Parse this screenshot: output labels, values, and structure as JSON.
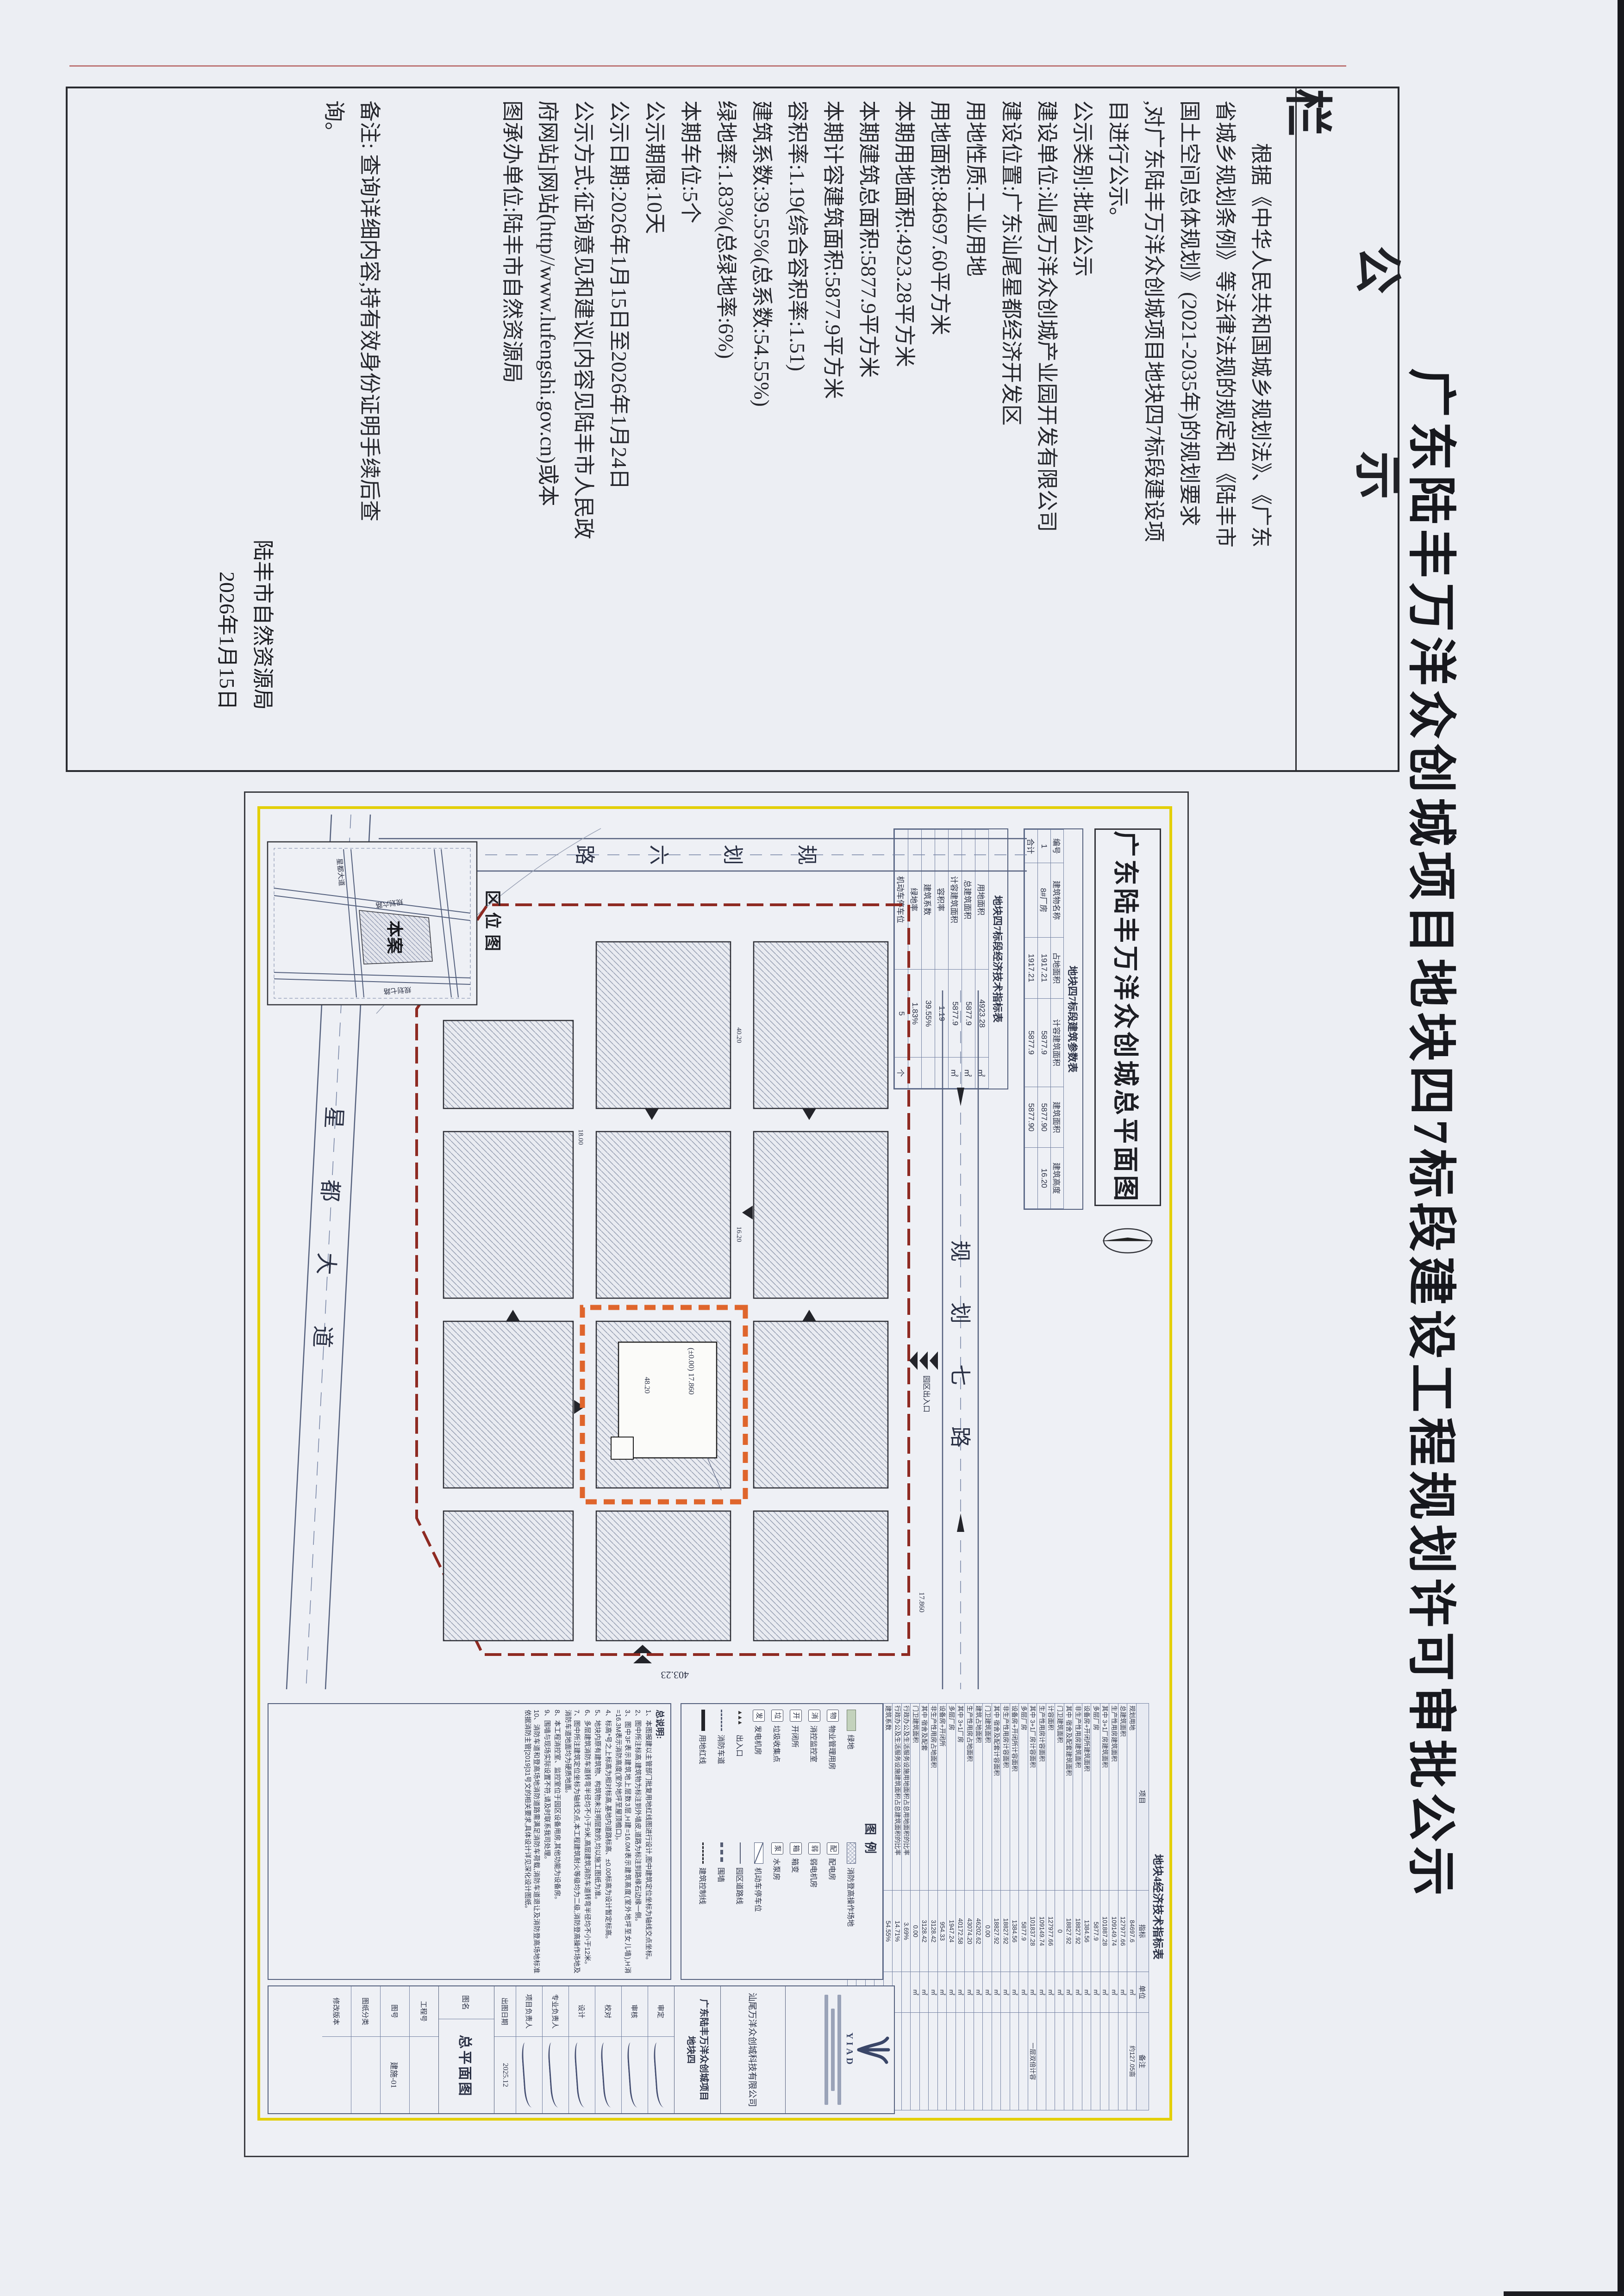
{
  "page": {
    "title": "广东陆丰万洋众创城项目地块四7标段建设工程规划许可审批公示"
  },
  "notice": {
    "header": "公示栏",
    "lines": [
      "根据《中华人民共和国城乡规划法》、《广东",
      "省城乡规划条例》等法律法规的规定和《陆丰市",
      "国土空间总体规划》(2021-2035年)的规划要求",
      ",对广东陆丰万洋众创城项目地块四7标段建设项",
      "目进行公示。",
      "公示类别:批前公示",
      "建设单位:汕尾万洋众创城产业园开发有限公司",
      "建设位置:广东汕尾星都经济开发区",
      "用地性质:工业用地",
      "用地面积:84697.60平方米",
      "本期用地面积:4923.28平方米",
      "本期建筑总面积:5877.9平方米",
      "本期计容建筑面积:5877.9平方米",
      "容积率:1.19(综合容积率:1.51)",
      "建筑系数:39.55%(总系数:54.55%)",
      "绿地率:1.83%(总绿地率:6%)",
      "本期车位:5个",
      "公示期限:10天",
      "公示日期:2026年1月15日至2026年1月24日",
      "公示方式:征询意见和建议[内容见陆丰市人民政",
      "府网站]网站(http//www.lufengshi.gov.cn)或本",
      "图承办单位:陆丰市自然资源局",
      "",
      "",
      "",
      "备注: 查询详细内容,持有效身份证明手续后查",
      "询。",
      ""
    ],
    "sign_org": "陆丰市自然资源局",
    "sign_date": "2026年1月15日"
  },
  "plan": {
    "title": "广东陆丰万洋众创城总平面图",
    "param_table": {
      "title": "地块四7标段建筑参数表",
      "headers": [
        "编号",
        "建筑物名称",
        "占地面积",
        "计容建筑面积",
        "建筑面积",
        "建筑高度"
      ],
      "rows": [
        [
          "1",
          "8#厂房",
          "1917.21",
          "5877.9",
          "5877.90",
          "16.20"
        ],
        [
          "合计",
          "",
          "1917.21",
          "5877.9",
          "5877.90",
          ""
        ]
      ]
    },
    "section_table": {
      "title": "地块四7标段经济技术指标表",
      "rows": [
        [
          "用地面积",
          "4923.28",
          "㎡"
        ],
        [
          "总建筑面积",
          "5877.9",
          "㎡"
        ],
        [
          "计容建筑面积",
          "5877.9",
          "㎡"
        ],
        [
          "容积率",
          "1.19",
          ""
        ],
        [
          "建筑系数",
          "39.55%",
          ""
        ],
        [
          "绿地率",
          "1.83%",
          ""
        ],
        [
          "机动车停车位",
          "5",
          "个"
        ]
      ]
    },
    "main_table": {
      "title": "地块4经济技术指标表",
      "headers": [
        "项目",
        "指标",
        "单位",
        "备注"
      ],
      "rows": [
        [
          "规划用地",
          "84697.6",
          "㎡",
          "约127.05亩"
        ],
        [
          "总建筑面积",
          "127977.66",
          "㎡",
          ""
        ],
        [
          "生产性用房建筑面积",
          "109149.74",
          "㎡",
          ""
        ],
        [
          "其中 3+1厂房建筑面积",
          "101887.28",
          "㎡",
          ""
        ],
        [
          "多层厂房",
          "5877.9",
          "㎡",
          ""
        ],
        [
          "设备房+开闭所建筑面积",
          "1384.56",
          "㎡",
          ""
        ],
        [
          "非生产性用房建筑面积",
          "18827.92",
          "㎡",
          ""
        ],
        [
          "其中 宿舍及配套建筑面积",
          "18827.92",
          "㎡",
          ""
        ],
        [
          "门卫建筑面积",
          "0",
          "㎡",
          ""
        ],
        [
          "计容面积",
          "127977.66",
          "㎡",
          ""
        ],
        [
          "生产性用房计容面积",
          "109149.74",
          "㎡",
          ""
        ],
        [
          "其中 3+1厂房计容面积",
          "101837.28",
          "㎡",
          "一层双倍计容"
        ],
        [
          "多层厂房",
          "5877.9",
          "㎡",
          ""
        ],
        [
          "设备房+开闭所计容面积",
          "1384.56",
          "㎡",
          ""
        ],
        [
          "非生产性用房计容面积",
          "18827.92",
          "㎡",
          ""
        ],
        [
          "其中 宿舍及配套计容面积",
          "18827.92",
          "㎡",
          ""
        ],
        [
          "门卫建筑面积",
          "0.00",
          "㎡",
          ""
        ],
        [
          "建筑占地面积",
          "46202.62",
          "㎡",
          ""
        ],
        [
          "生产性用房占地面积",
          "43074.20",
          "㎡",
          ""
        ],
        [
          "其中 3+1厂房",
          "40172.58",
          "㎡",
          ""
        ],
        [
          "多层厂房",
          "1947.24",
          "㎡",
          ""
        ],
        [
          "设备房+开闭所",
          "954.33",
          "㎡",
          ""
        ],
        [
          "非生产性用房占地面积",
          "3128.42",
          "㎡",
          ""
        ],
        [
          "其中 宿舍及配套",
          "3128.42",
          "㎡",
          ""
        ],
        [
          "门卫建筑面积",
          "0.00",
          "㎡",
          ""
        ],
        [
          "行政办公及生活服务设施用地面积占总用地面积的比率",
          "3.69%",
          "",
          ""
        ],
        [
          "行政办公及生活服务设施建筑面积占总建筑面积的比率",
          "14.71%",
          "",
          ""
        ],
        [
          "建筑系数",
          "54.55%",
          "",
          ""
        ],
        [
          "容积率",
          "1.51",
          "",
          ""
        ],
        [
          "绿地面积",
          "5066.62",
          "㎡",
          ""
        ],
        [
          "绿地率",
          "6%",
          "",
          "≤20%"
        ],
        [
          "机动车停车位",
          "256",
          "个",
          "机动车:0.2辆/100㎡"
        ]
      ]
    },
    "legend": {
      "title": "图例",
      "items": [
        {
          "label": "绿地",
          "sym": "green"
        },
        {
          "label": "消防登高操作场地",
          "sym": "hatchx"
        },
        {
          "label": "物业管理用房",
          "sym": "chip",
          "ch": "物"
        },
        {
          "label": "配电房",
          "sym": "chip",
          "ch": "配"
        },
        {
          "label": "消控监控室",
          "sym": "chip",
          "ch": "消"
        },
        {
          "label": "弱电机房",
          "sym": "chip",
          "ch": "弱"
        },
        {
          "label": "开闭所",
          "sym": "chip",
          "ch": "开"
        },
        {
          "label": "箱变",
          "sym": "chip",
          "ch": "箱"
        },
        {
          "label": "垃圾收集点",
          "sym": "chip",
          "ch": "垃"
        },
        {
          "label": "水泵房",
          "sym": "chip",
          "ch": "泵"
        },
        {
          "label": "发电机房",
          "sym": "chip",
          "ch": "发"
        },
        {
          "label": "机动车停车位",
          "sym": "boxdiag"
        },
        {
          "label": "出入口",
          "sym": "chev"
        },
        {
          "label": "园区道路线",
          "sym": "thin"
        },
        {
          "label": "消防车道",
          "sym": "dash"
        },
        {
          "label": "围墙",
          "sym": "fence"
        },
        {
          "label": "用地红线",
          "sym": "thick"
        },
        {
          "label": "建筑控制线",
          "sym": "dashdot"
        }
      ]
    },
    "notes": {
      "title": "总说明:",
      "items": [
        "1、本图报建以主管部门批复用地红线图进行设计,图中建筑定位坐标为轴线交点坐标。",
        "2、图中所注标高:建筑物为标注到外墙皮,道路为标注到路缘石边缘一侧。",
        "3、图中3F表示建筑地上层数3层,H建=16.0M表示建筑高度(室外地坪至女儿墙),H消=16.3M表示消防高度(室外地坪至屋顶檐口)。",
        "4、标高*号之上标高为相对标高,基地内道路标高、±0.00标高为设计暂定标高。",
        "5、地块内原有建筑物、构筑物未注明层数的,均以施工图纸为准。",
        "6、多层建筑消防车道转弯半径均不小于9米,高层建筑消防车道转弯半径均不小于12米。",
        "7、图中所注建筑定位坐标为轴线交点,本工程建筑耐火等级均为二级,消防登高操作场地及消防车道地面均为硬质地面。",
        "8、本工程消控室、监控室位于园区设备用房,其他功能为设备房。",
        "9、围墙与现场实际设置不符,请及时联系我司处理。",
        "10、消防车道和登高场地消防道路需满足消防车荷载,消防车道退让及消防登高场地标准依据消防主管[2019]31号文的相关要求,具体设计详见深化设计图纸。"
      ]
    },
    "roads": {
      "north": "规划七路",
      "west_chars": [
        "规",
        "划",
        "六",
        "路"
      ],
      "south": "星都大道"
    },
    "labels": {
      "entrance": "园区出入口",
      "site": "本案",
      "inset_title": "区位图",
      "level": "(±0.00) 17.860"
    },
    "dims": {
      "d1": "403.23",
      "d2": "17.860",
      "d3": "48.20",
      "d4": "40.20",
      "d5": "16.20",
      "d6": "18.00"
    },
    "inset_roads": {
      "r1": "规划六路",
      "r2": "星都大道",
      "r3": "规划七路"
    },
    "titleblock": {
      "stamp_logo": "YIAD",
      "company": "汕尾万洋众创城科技有限公司",
      "project_line1": "广东陆丰万洋众创城项目",
      "project_line2": "地块四",
      "sig_rows": [
        "审定",
        "审核",
        "校对",
        "设计",
        "专业负责人",
        "项目负责人"
      ],
      "date_label": "出图日期",
      "date_value": "2025.12",
      "figname_label": "图名",
      "figname_value": "总平面图",
      "rows": [
        {
          "label": "工程号",
          "value": ""
        },
        {
          "label": "图号",
          "value": "建施-01"
        },
        {
          "label": "图纸分类",
          "value": ""
        },
        {
          "label": "修改版本",
          "value": ""
        }
      ]
    }
  }
}
